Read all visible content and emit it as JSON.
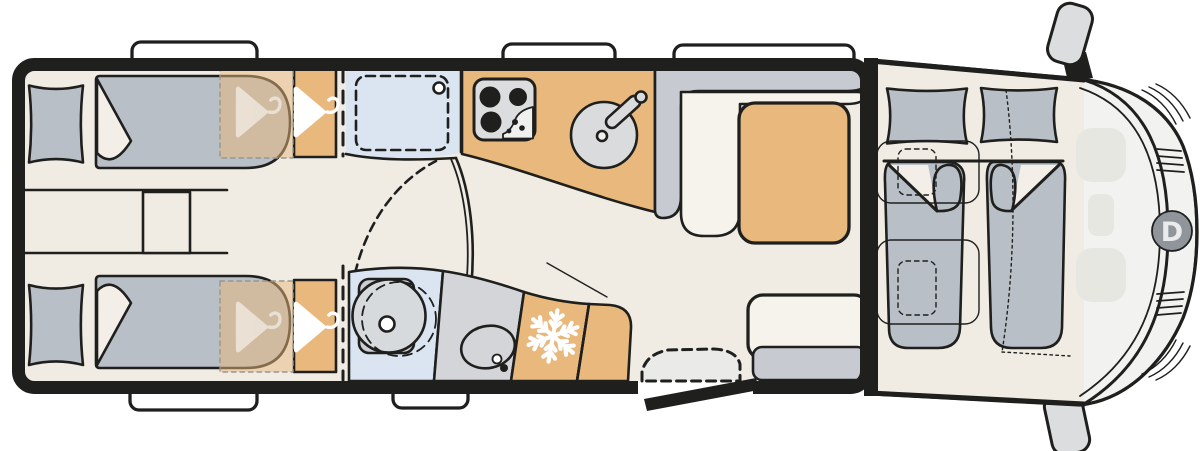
{
  "meta": {
    "type": "floorplan",
    "subject": "motorhome top view layout drawing"
  },
  "logo": {
    "letter": "D"
  },
  "icons": {
    "wardrobe": "hanger-icon",
    "refrigerator": "snowflake-icon",
    "front_badge": "letter-d-logo"
  },
  "colors": {
    "white": "#FFFFFF",
    "outline": "#1F1F1D",
    "floor": "#F0ECE4",
    "wood": "#E8B87C",
    "overlay_edge": "#9A968C",
    "mattress": "#B9BFC7",
    "cushion": "#C7CBD1",
    "upholstery": "#F6F3ED",
    "fold": "#F3EFE8",
    "shower_blue": "#DAE5F1",
    "counter": "#D3D5D8",
    "sink": "#DADBDD",
    "stove": "#DCDDDE",
    "stove_notch": "#F0F0EE",
    "appliance": "#EFEFEF",
    "toilet": "#D7DADD",
    "pedestal": "#CBCED3",
    "cab_body": "#F2F2F1",
    "cab_seat": "#E7E7E2",
    "logo_bg": "#8F959B",
    "logo_letter": "#E9EBED",
    "mirror": "#DCDDDE",
    "step": "#EAEAE8"
  }
}
